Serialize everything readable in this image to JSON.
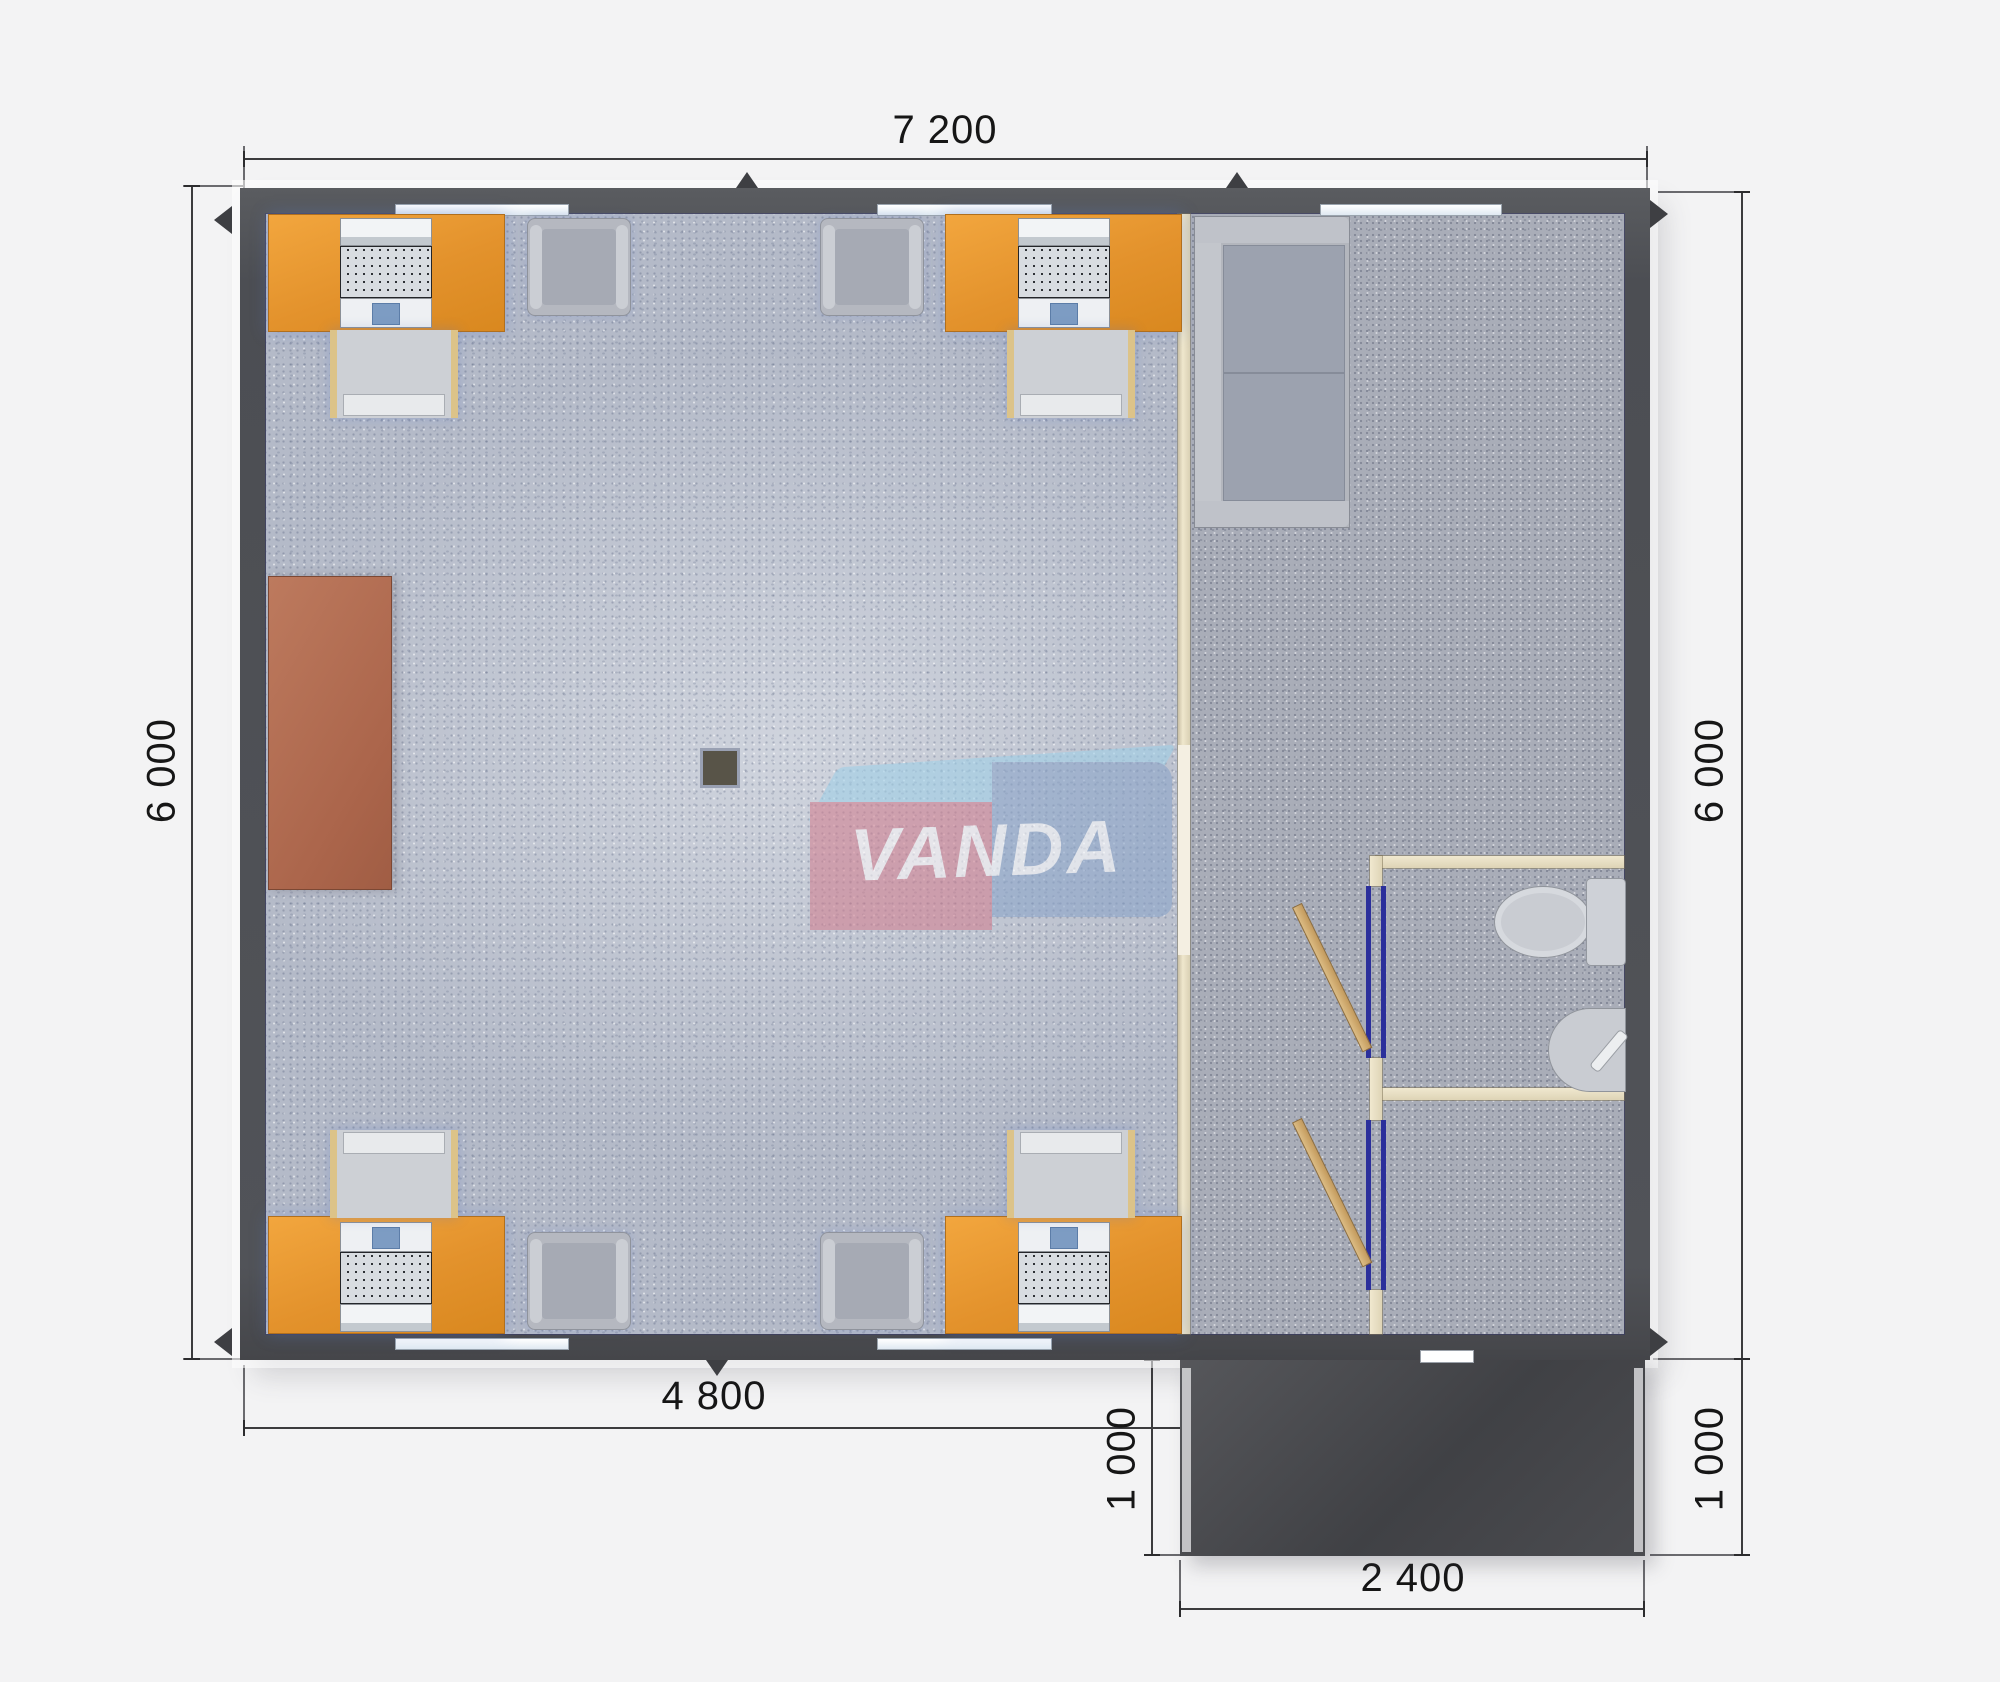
{
  "title": "Modular office floor plan 7.2 x 6.0 m",
  "watermark": {
    "text": "VANDA",
    "pink": "#d27f90",
    "blue": "#8aa4c9",
    "band": "#9fd0e8"
  },
  "dimensions": {
    "top": {
      "label": "7 200"
    },
    "left": {
      "label": "6 000"
    },
    "right": {
      "label": "6 000"
    },
    "bottom_office": {
      "label": "4 800"
    },
    "porch_left": {
      "label": "1 000"
    },
    "porch_right": {
      "label": "1 000"
    },
    "porch_bottom": {
      "label": "2 400"
    }
  },
  "rooms": {
    "office": {
      "name": "open office",
      "floor_color": "#b4bac8"
    },
    "lounge": {
      "name": "entrance lounge",
      "floor_color": "#a9adb8"
    },
    "wc": {
      "name": "toilet room"
    },
    "storage": {
      "name": "utility room"
    },
    "porch": {
      "name": "entrance porch",
      "color": "#4b4c50"
    }
  },
  "furniture": {
    "desk_color": "#e3922c",
    "desks": [
      "desk-top-left",
      "desk-top-right",
      "desk-bottom-left",
      "desk-bottom-right"
    ],
    "computers": 4,
    "office_chairs": 4,
    "armchairs": 4,
    "cabinet_color": "#ab654b",
    "sofa_color": "#b3b6bd",
    "fixtures": [
      "toilet",
      "corner-sink"
    ],
    "doors": [
      "wc-door",
      "utility-door",
      "entrance-door"
    ]
  },
  "palette": {
    "wall": "#4c4e53",
    "partition": "#efe7cd",
    "door_frame_blue": "#2b2f9b",
    "door_leaf_wood": "#c39a5d",
    "dimension_text": "#161616",
    "background": "#f3f3f4"
  }
}
